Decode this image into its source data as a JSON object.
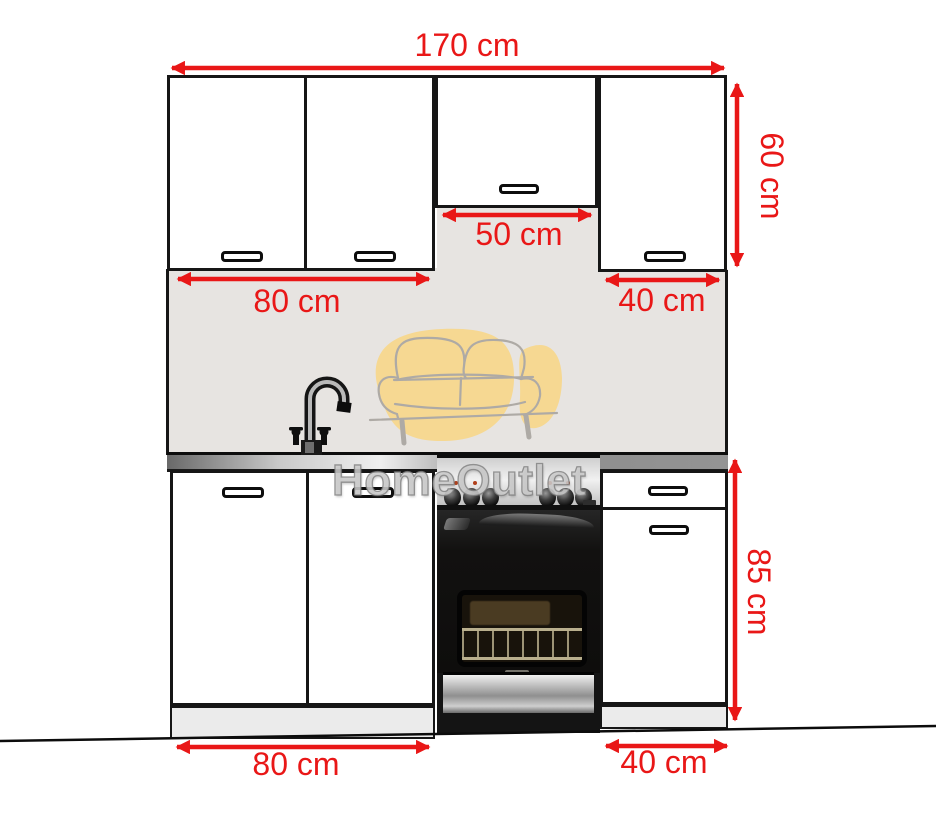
{
  "watermark": {
    "brand": "HomeOutlet"
  },
  "dimensions": {
    "total_width": "170 cm",
    "wall_cabinet_height": "60 cm",
    "wall_middle_width": "50 cm",
    "wall_left_width": "80 cm",
    "wall_right_width": "40 cm",
    "base_height": "85 cm",
    "base_left_width": "80 cm",
    "base_right_width": "40 cm"
  },
  "colors": {
    "dimension_red": "#e91717",
    "cabinet_outline": "#161616",
    "backsplash_gray": "#e7e4e1",
    "watermark_yellow": "#f6d892",
    "plinth_gray": "#ebebeb"
  }
}
